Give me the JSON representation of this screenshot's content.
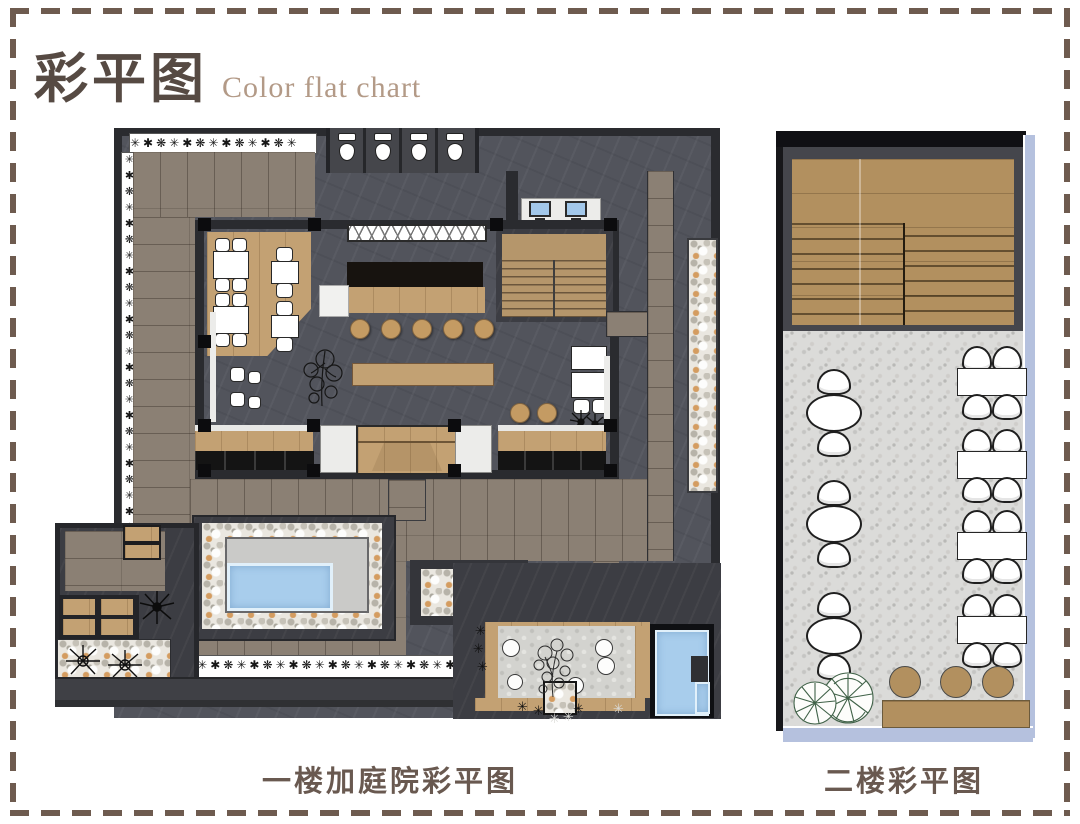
{
  "header": {
    "title_cn": "彩平图",
    "title_en": "Color flat chart"
  },
  "plans": {
    "first_floor": {
      "caption": "一楼加庭院彩平图"
    },
    "second_floor": {
      "caption": "二楼彩平图"
    }
  },
  "decor": {
    "plant_glyph": "✳",
    "plant_row_top": "✳✱❋✳✱❋✳✱❋✳✱❋✳",
    "plant_col_left": "✳✱❋✳✱❋✳✱❋✳✱❋✳✱❋✳✱❋✳✱❋✳✱❋✳✱",
    "plant_row_bottom": "✳✱❋✳✱❋✳✱❋✳✱❋✳✱❋✳✱❋✳✱❋✳✱❋✳✱❋"
  },
  "colors": {
    "border_dash": "#6e5b4f",
    "title_cn": "#564a43",
    "title_en": "#b39a87",
    "caption": "#695950",
    "slate": "#52545c",
    "slate_dark": "#3c3d43",
    "wall": "#2a2b2f",
    "wood_gray": "#8b8074",
    "wood_warm": "#c3a173",
    "wood_floor2": "#b2905f",
    "water_blue": "#a8cdec",
    "terrazzo": "#dbdbd9",
    "rail_blue": "#b5c1de",
    "pebble_tan": "#d49c60"
  }
}
